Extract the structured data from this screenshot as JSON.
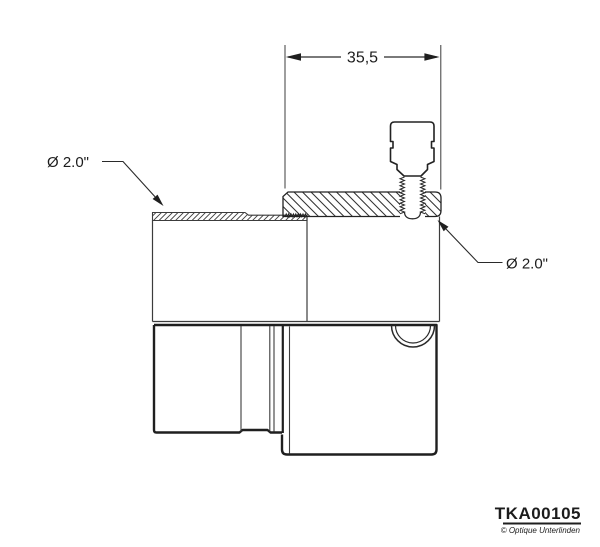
{
  "drawing": {
    "type": "technical-section-drawing",
    "dimension": {
      "value": "35,5"
    },
    "callouts": {
      "left_diameter": "Ø 2.0\"",
      "right_diameter": "Ø 2.0\""
    },
    "title_block": {
      "part_number": "TKA00105",
      "copyright": "© Optique Unterlinden"
    },
    "colors": {
      "outline_thick": "#1f1f1f",
      "outline_thin": "#3c3c3c",
      "hatch": "#3c3c3c",
      "background": "#ffffff"
    }
  }
}
